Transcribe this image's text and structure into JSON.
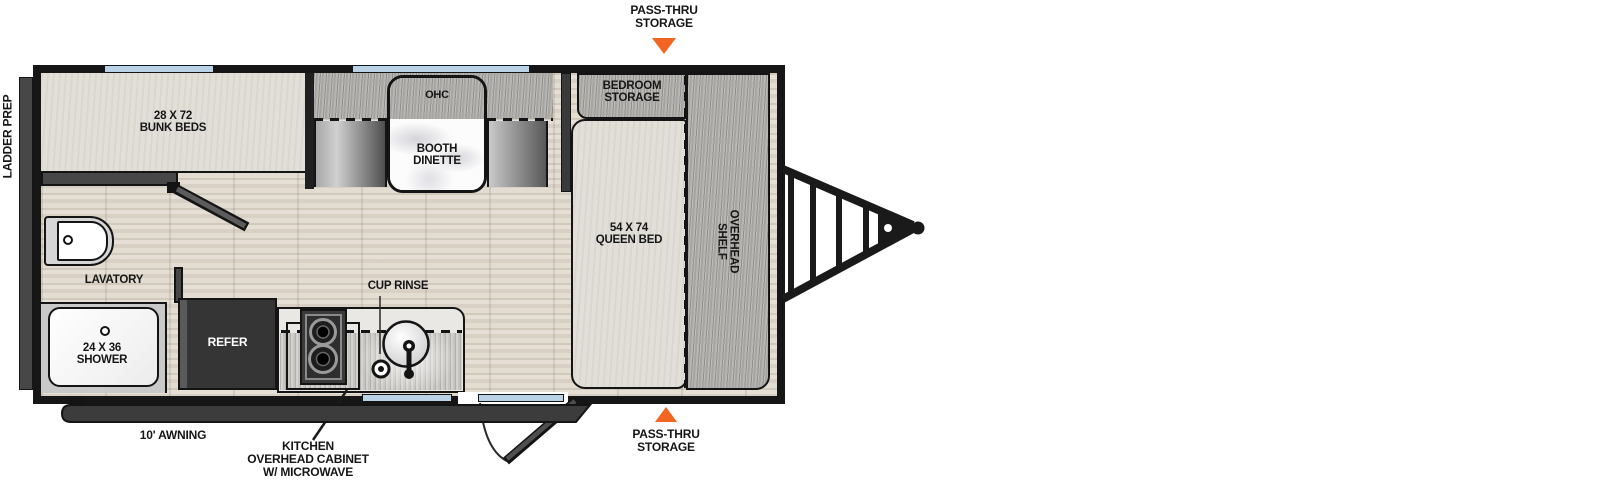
{
  "title": "Travel trailer floorplan diagram",
  "colors": {
    "accent_orange": "#F26522",
    "window_blue": "#B9D2E6",
    "wall_black": "#161616",
    "interior_wall_grey": "#474747",
    "laminate_grey": "#B2B0AD",
    "floor_beige": "#DDD6CB"
  },
  "labels": {
    "ladder_prep": "LADDER PREP",
    "pass_thru_top": [
      "PASS-THRU",
      "STORAGE"
    ],
    "pass_thru_bottom": [
      "PASS-THRU",
      "STORAGE"
    ],
    "bunk_beds": [
      "28 X 72",
      "BUNK BEDS"
    ],
    "ohc": "OHC",
    "booth_dinette": [
      "BOOTH",
      "DINETTE"
    ],
    "bedroom_storage": [
      "BEDROOM",
      "STORAGE"
    ],
    "queen_bed": [
      "54 X 74",
      "QUEEN BED"
    ],
    "overhead_shelf": [
      "OVERHEAD",
      "SHELF"
    ],
    "lavatory": "LAVATORY",
    "shower": [
      "24 X 36",
      "SHOWER"
    ],
    "refer": "REFER",
    "cup_rinse": "CUP RINSE",
    "awning": "10' AWNING",
    "kitchen_ohc": [
      "KITCHEN",
      "OVERHEAD CABINET",
      "W/ MICROWAVE"
    ]
  }
}
